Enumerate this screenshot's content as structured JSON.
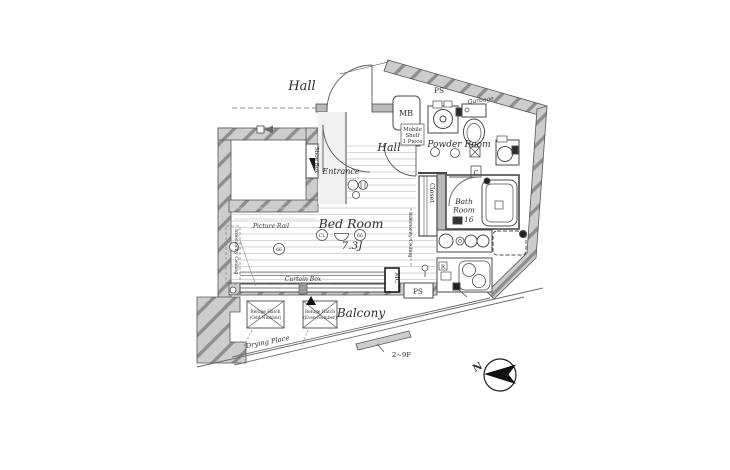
{
  "colors": {
    "wall_fill": "#cdcdcd",
    "wall_hatch": "#8e8e8e",
    "line": "#4a4a4a",
    "floor_line": "#c9c9c9",
    "text": "#2e2e2e"
  },
  "exterior": {
    "hall_label": "Hall",
    "floor_range_label": "2~9F",
    "compass_north": "N"
  },
  "rooms": {
    "entrance": {
      "name": "Entrance",
      "shoe_box": "Shoe Box"
    },
    "hall": {
      "name": "Hall"
    },
    "powder_room": {
      "name": "Powder Room",
      "mb": "MB",
      "ps": "PS",
      "garbage": "Garbage",
      "mobile_shelf_lines": [
        "Mobile",
        "Shelf",
        "1 Piece"
      ],
      "c_label": "C"
    },
    "bath_room": {
      "name_lines": [
        "Bath",
        "Room"
      ],
      "size": "1116"
    },
    "closet": {
      "name": "Closet"
    },
    "bed_room": {
      "name": "Bed Room",
      "size": "7.3J",
      "picture_rail": "Picture Rail",
      "curtain_box": "Curtain Box",
      "inferiority_ceiling_left": "Inferiority Ceiling",
      "inferiority_ceiling_right": "Inferiority Ceiling",
      "symbol_cl": "CL",
      "symbol_a": "66",
      "symbol_b": "66"
    },
    "kitchen": {
      "refrigerator_label": "R",
      "mc": "MC",
      "ps": "PS"
    },
    "balcony": {
      "name": "Balcony",
      "drying_place": "Drying Place",
      "refuge_hatch_left_lines": [
        "Refuge Hatch",
        "(Odd Number)"
      ],
      "refuge_hatch_right_lines": [
        "Refuge Hatch",
        "(Even Number)"
      ]
    }
  }
}
